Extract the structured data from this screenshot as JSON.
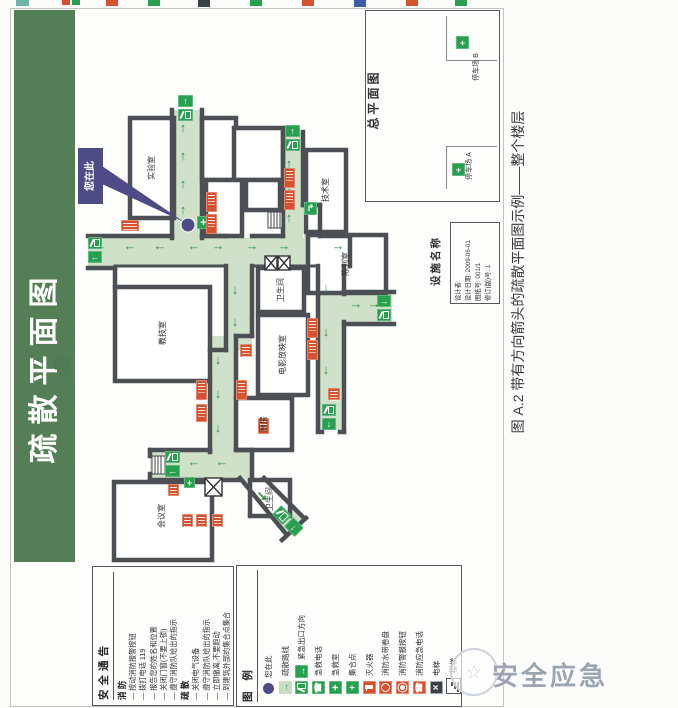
{
  "banner": {
    "title": "疏散平面图",
    "floor": "1层"
  },
  "caption": "图 A.2  带有方向箭头的疏散平面图示例——整个楼层",
  "watermark": "安全应急",
  "callout": {
    "you_are_here": "您在此"
  },
  "overview": {
    "title": "总平面图",
    "parking_b": "停车场 B",
    "parking_a": "停车场 A"
  },
  "facility": {
    "label": "设施名称",
    "lines": [
      "设计者:",
      "设计日期: 2009-06-01",
      "图纸号: 001/1",
      "修订(版)号: 1"
    ]
  },
  "notice": {
    "title": "安全通告",
    "fire_title": "消  防",
    "fire_items": [
      "— 按动消防报警按钮",
      "— 拨打电话 119",
      "— 报告您的姓名和位置",
      "— 关闭门窗(不要上锁)",
      "— 遵守消防队给出的指示"
    ],
    "evac_title": "疏  散",
    "evac_items": [
      "— 关闭电气设备",
      "— 遵守消防队给出的指示",
      "— 立即撤离,不要跑动",
      "— 到建筑外部的集合点集合"
    ]
  },
  "legend": {
    "title": "图  例",
    "items": [
      "您在此",
      "疏散路线",
      "紧急出口方向",
      "急救电话",
      "急救室",
      "集合点",
      "灭火器",
      "消防水带卷盘",
      "消防警报按钮",
      "消防应急电话",
      "电梯",
      "楼梯"
    ]
  },
  "plan": {
    "rooms": [
      "实验室",
      "技术室",
      "陈列室",
      "卫生间",
      "教技室",
      "电影放映室",
      "厨房",
      "会议室",
      "卫生间"
    ]
  },
  "icons": {
    "up": "↑",
    "down": "↓",
    "left": "←",
    "right": "→",
    "down_right": "↘",
    "turn": "↱",
    "cross": "+",
    "phone": "☎",
    "close": "×",
    "star": "☆",
    "plus4": "+"
  },
  "colors": {
    "banner_green": "#547e56",
    "corridor_green": "#cfe1c9",
    "sign_green": "#27a04f",
    "sign_red": "#d8512e",
    "wall": "#4c5054",
    "purple": "#4d4c86"
  }
}
